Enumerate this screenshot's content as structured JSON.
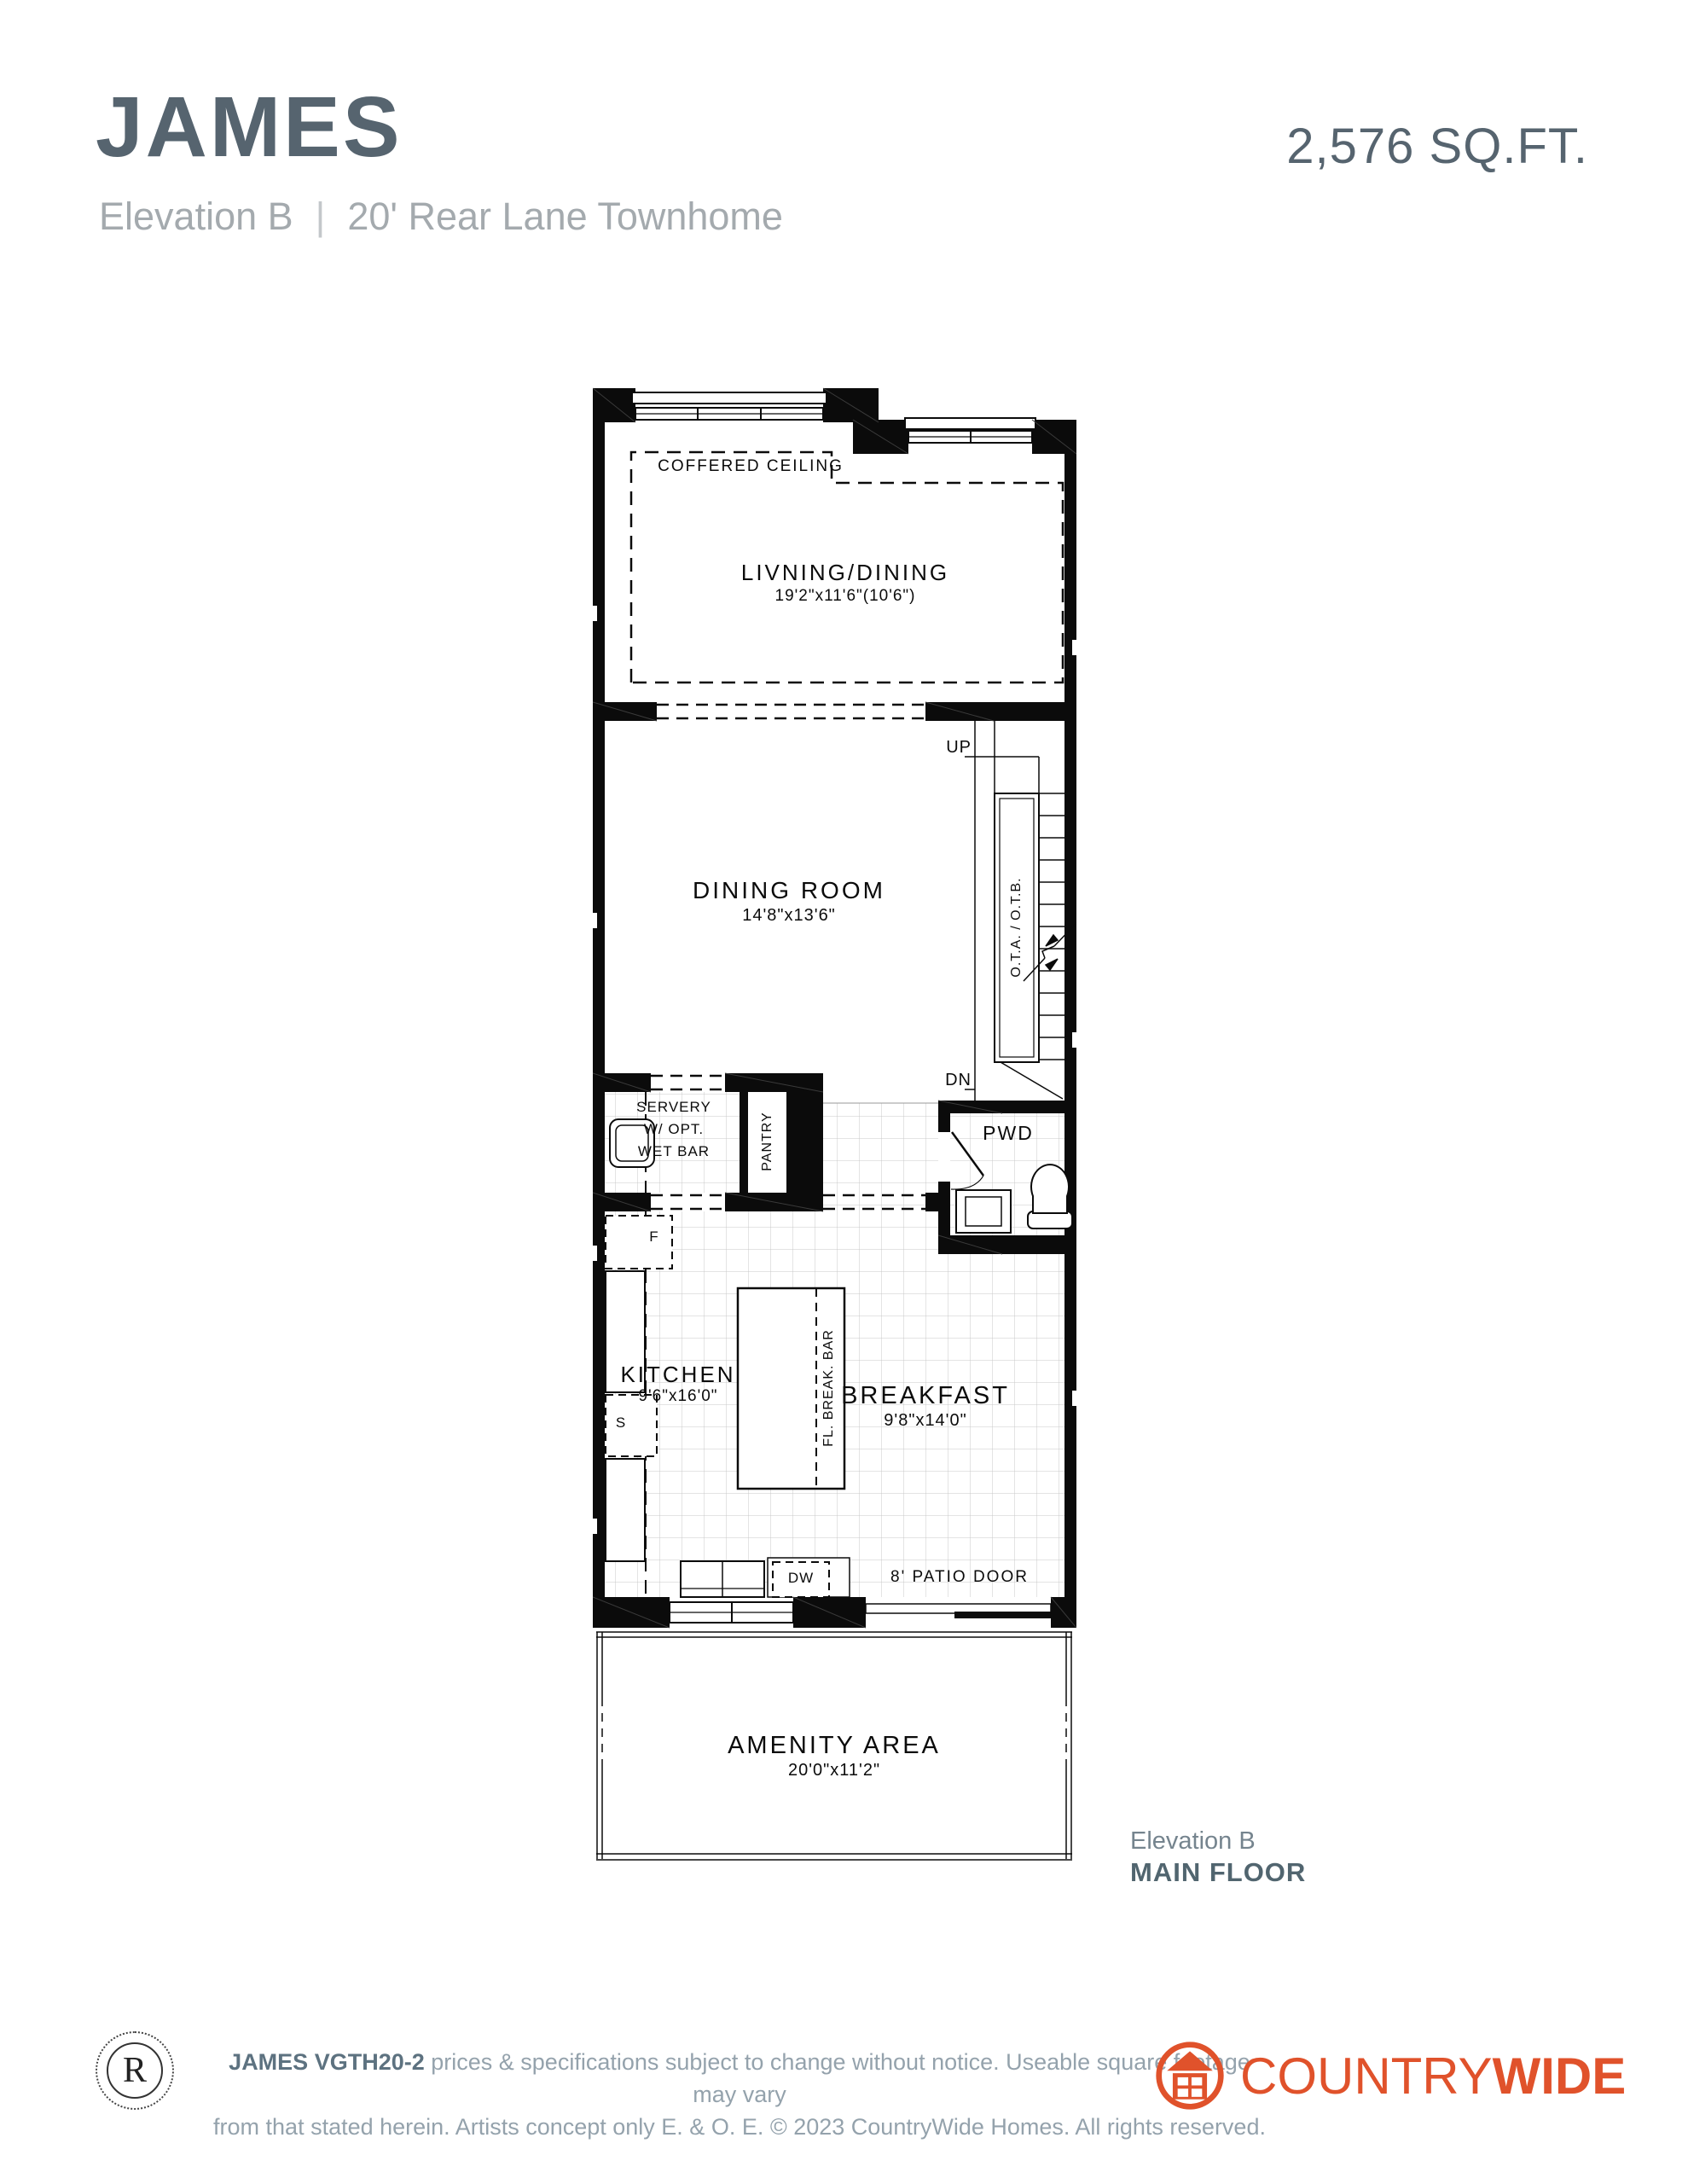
{
  "header": {
    "title": "JAMES",
    "sqft": "2,576 SQ.FT.",
    "elevation": "Elevation B",
    "separator": "|",
    "subtitle": "20' Rear Lane Townhome"
  },
  "plan": {
    "coffered": "COFFERED CEILING",
    "living": {
      "name": "LIVNING/DINING",
      "dims": "19'2\"x11'6\"(10'6\")"
    },
    "dining": {
      "name": "DINING ROOM",
      "dims": "14'8\"x13'6\""
    },
    "servery": {
      "line1": "SERVERY",
      "line2": "W/ OPT.",
      "line3": "WET BAR"
    },
    "pantry": "PANTRY",
    "pwd": "PWD",
    "kitchen": {
      "name": "KITCHEN",
      "dims": "9'6\"x16'0\""
    },
    "breakfast": {
      "name": "BREAKFAST",
      "dims": "9'8\"x14'0\""
    },
    "amenity": {
      "name": "AMENITY AREA",
      "dims": "20'0\"x11'2\""
    },
    "stairs": {
      "up": "UP",
      "dn": "DN",
      "ota": "O.T.A. / O.T.B."
    },
    "fixtures": {
      "f": "F",
      "s": "S",
      "dw": "DW",
      "island": "FL. BREAK. BAR",
      "patio": "8' PATIO DOOR"
    }
  },
  "caption": {
    "elevation": "Elevation B",
    "floor": "MAIN FLOOR"
  },
  "footer": {
    "mark": "R",
    "disclaimer": {
      "bold": "JAMES VGTH20-2",
      "line1_rest": " prices & specifications subject to change without notice. Useable square footage may vary",
      "line2": "from that stated herein. Artists concept only E. & O. E. © 2023 CountryWide Homes. All rights reserved."
    },
    "brand": {
      "regular": "COUNTRY",
      "bold": "WIDE"
    }
  },
  "colors": {
    "accent": "#E0522B",
    "title_dark": "#56646F",
    "subtitle_gray": "#A4AAAE",
    "footer_gray": "#94A2AC",
    "wall_black": "#0B0B0B"
  }
}
